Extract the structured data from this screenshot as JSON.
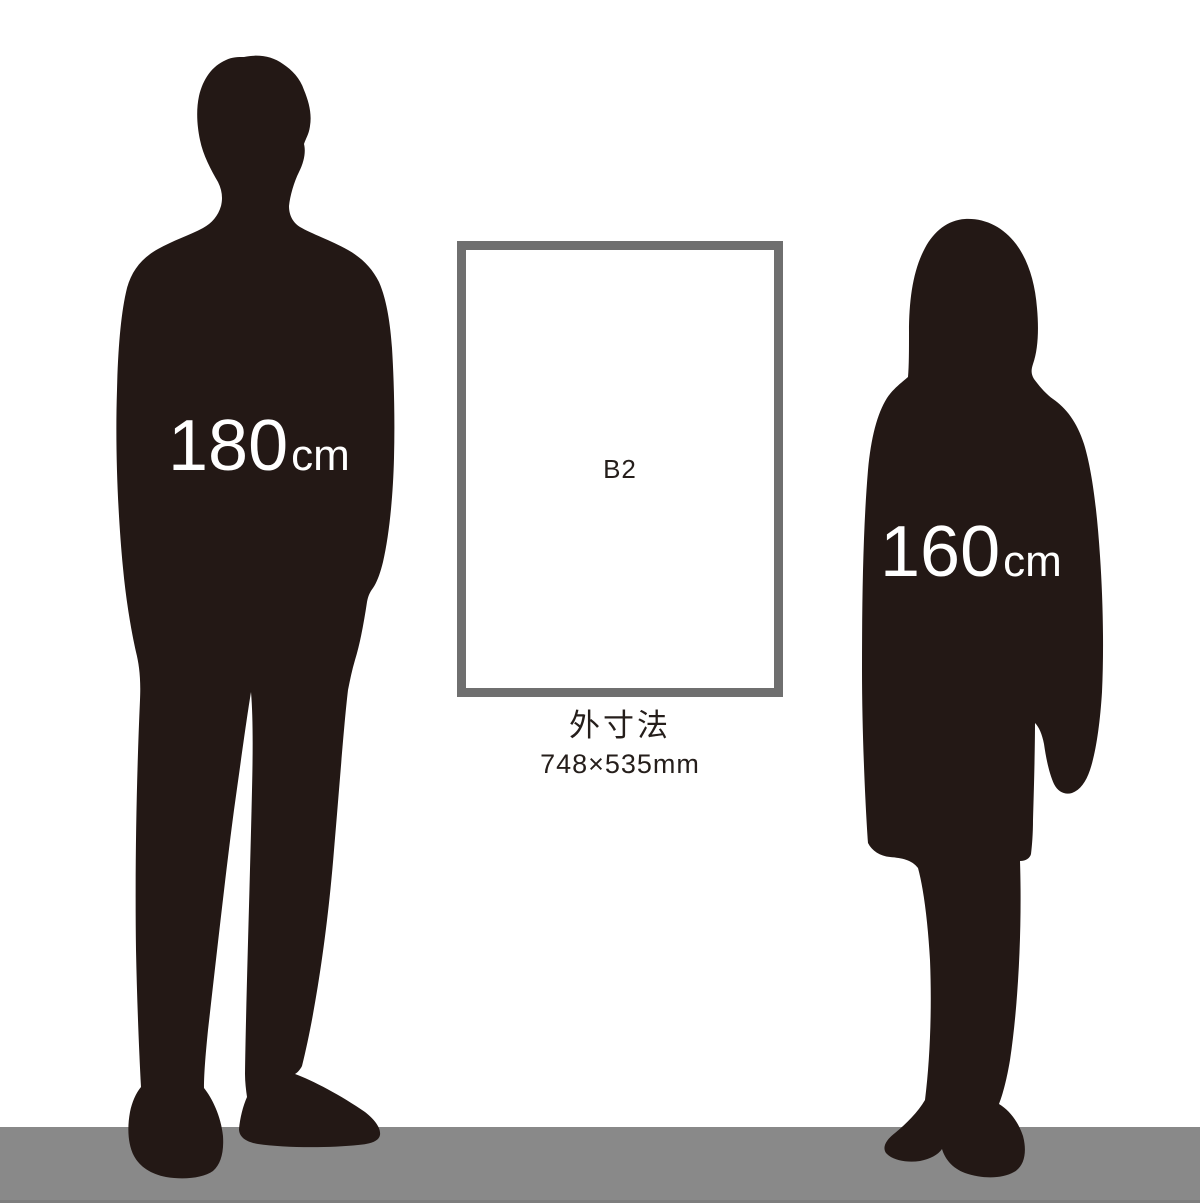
{
  "illustration": {
    "description": "Poster frame size comparison with human silhouettes"
  },
  "man": {
    "height_value": "180",
    "height_unit": "cm",
    "silhouette_color": "#231815",
    "label_color": "#ffffff"
  },
  "woman": {
    "height_value": "160",
    "height_unit": "cm",
    "silhouette_color": "#231815",
    "label_color": "#ffffff"
  },
  "frame": {
    "label": "B2",
    "border_color": "#6f6f6f",
    "fill_color": "#ffffff"
  },
  "caption": {
    "title": "外寸法",
    "dimensions": "748×535mm",
    "text_color": "#251e1b"
  },
  "floor": {
    "color": "#898989"
  },
  "background": "#ffffff"
}
